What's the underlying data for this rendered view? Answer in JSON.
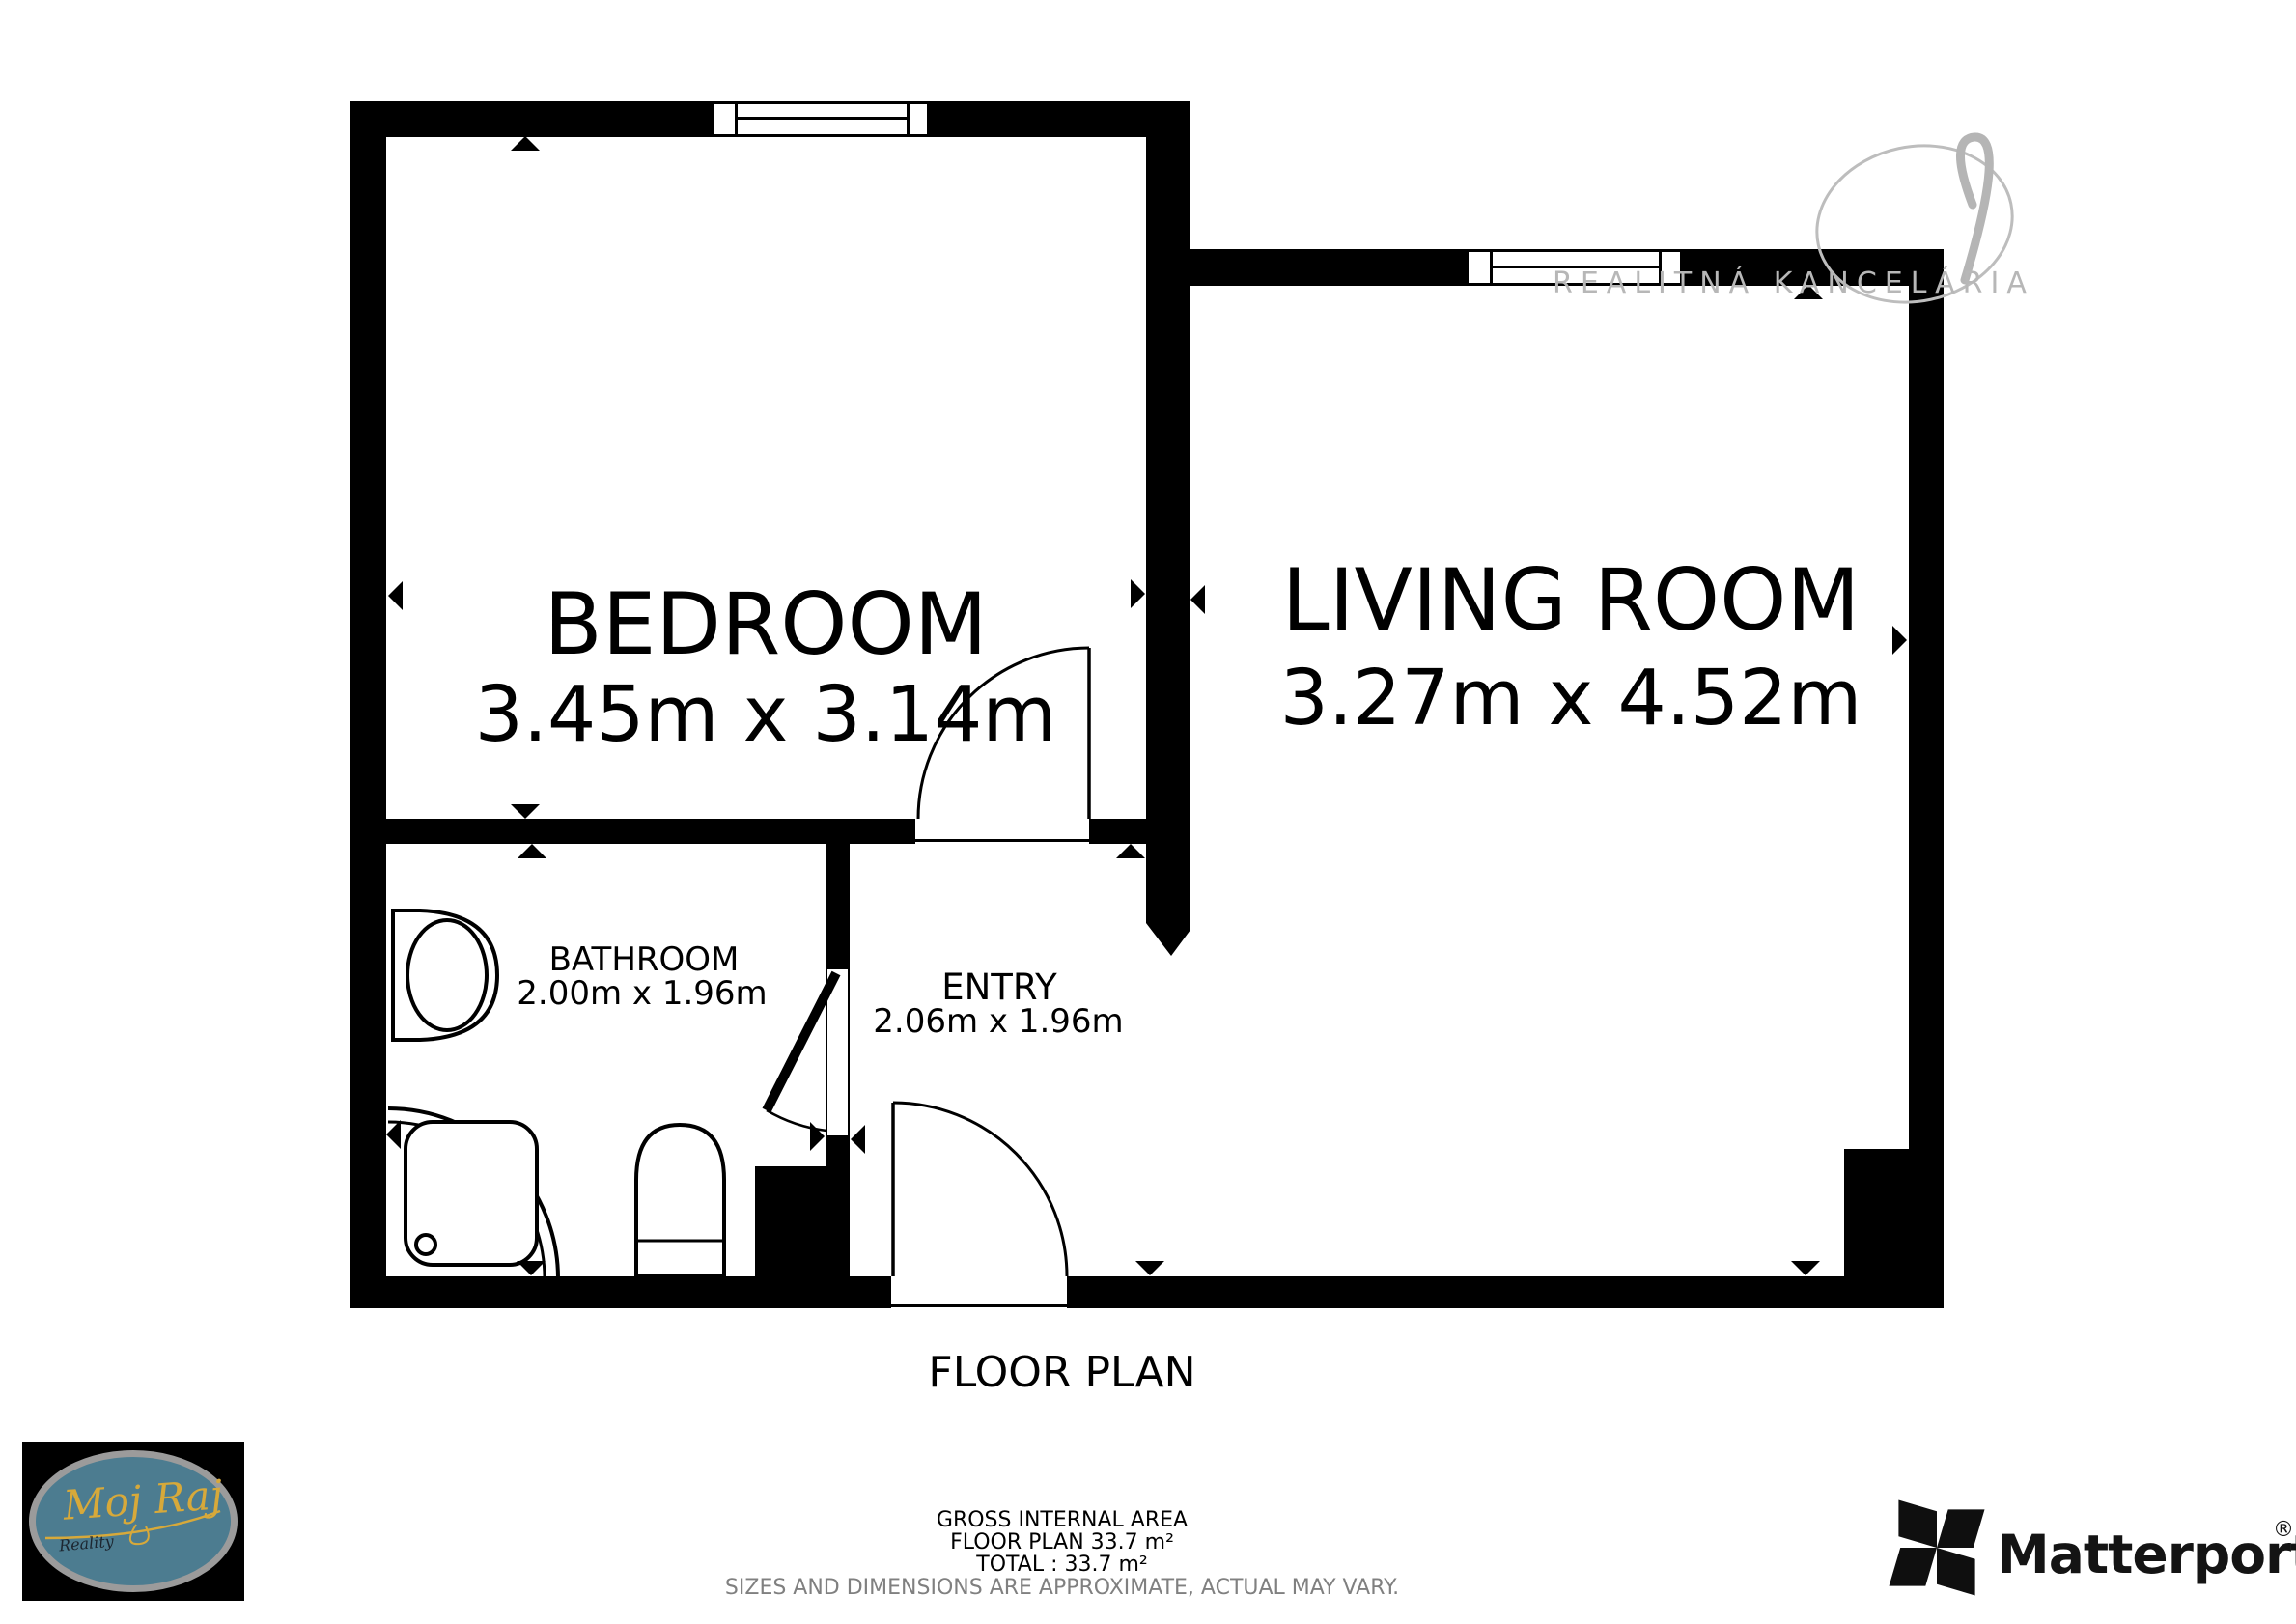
{
  "title": "FLOOR PLAN",
  "rooms": {
    "bedroom": {
      "name": "BEDROOM",
      "dims": "3.45m x 3.14m"
    },
    "living": {
      "name": "LIVING ROOM",
      "dims": "3.27m x 4.52m"
    },
    "bathroom": {
      "name": "BATHROOM",
      "dims": "2.00m x 1.96m"
    },
    "entry": {
      "name": "ENTRY",
      "dims": "2.06m x 1.96m"
    }
  },
  "watermark": {
    "text": "REALITNÁ KANCELÁRIA"
  },
  "footer": {
    "gross_internal_area": "GROSS INTERNAL AREA",
    "floor_plan_area": "FLOOR PLAN 33.7 m²",
    "total_area": "TOTAL :  33.7 m²",
    "disclaimer": "SIZES AND DIMENSIONS ARE APPROXIMATE, ACTUAL MAY VARY."
  },
  "branding": {
    "agency": {
      "script_text": "Moj Raj",
      "sub_text": "Reality"
    },
    "matterport": {
      "text": "Matterport",
      "registered": "®"
    }
  },
  "colors": {
    "wall": "#000000",
    "background": "#ffffff",
    "watermark": "#b7b7b7",
    "disclaimer": "#808080",
    "logo_oval": "#4c7c90",
    "logo_script": "#d7a93a"
  }
}
